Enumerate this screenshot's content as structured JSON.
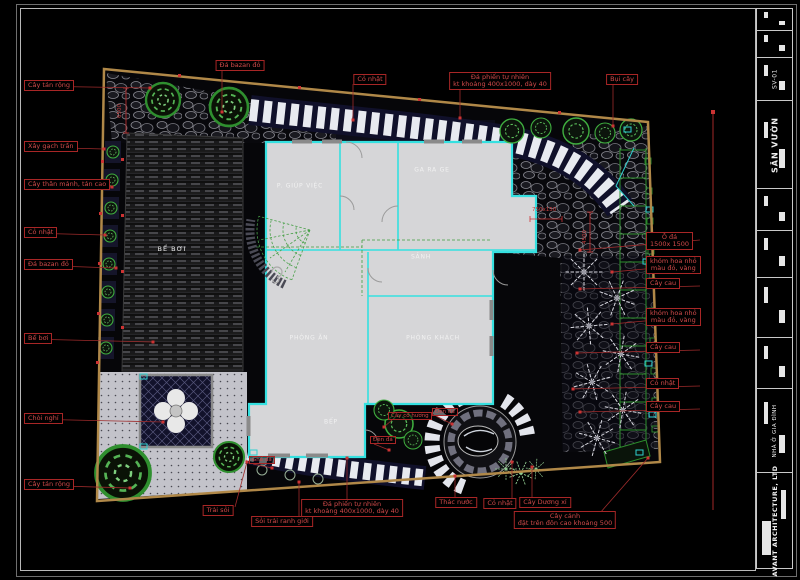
{
  "drawing": {
    "discipline": "landscape-site-plan",
    "sheet_title": "SÂN VƯỜN",
    "sheet_number": "SV-01",
    "project": "NHÀ Ở GIA ĐÌNH",
    "firm": "AVANT ARCHITECTURE, LTD"
  },
  "annotations": {
    "left": [
      {
        "text": "Cây tán rộng",
        "y": 86,
        "tx": 150,
        "ty": 88
      },
      {
        "text": "Xây gạch trần",
        "y": 147,
        "tx": 104,
        "ty": 149
      },
      {
        "text": "Cây thân mảnh, tán cao",
        "y": 185,
        "tx": 112,
        "ty": 187
      },
      {
        "text": "Cỏ nhật",
        "y": 233,
        "tx": 105,
        "ty": 235
      },
      {
        "text": "Đá bazan đỏ",
        "y": 265,
        "tx": 116,
        "ty": 268
      },
      {
        "text": "Bể bơi",
        "y": 339,
        "tx": 153,
        "ty": 342
      },
      {
        "text": "Chòi nghỉ",
        "y": 419,
        "tx": 163,
        "ty": 422
      },
      {
        "text": "Cây tán rộng",
        "y": 485,
        "tx": 130,
        "ty": 488
      }
    ],
    "top": [
      {
        "lines": [
          "Đá bazan đỏ"
        ],
        "cx": 240,
        "y": 60,
        "lx": 222,
        "ty": 112
      },
      {
        "lines": [
          "Cỏ nhật"
        ],
        "cx": 370,
        "y": 74,
        "lx": 353,
        "ty": 120
      },
      {
        "lines": [
          "Đá phiến tự nhiên",
          "kt khoảng 400x1000, dày 40"
        ],
        "cx": 500,
        "y": 72,
        "lx": 460,
        "ty": 118
      },
      {
        "lines": [
          "Bụi cây"
        ],
        "cx": 622,
        "y": 74,
        "lx": 613,
        "ty": 126
      }
    ],
    "right": [
      {
        "lines": [
          "Ô đá",
          "1500x 1500"
        ],
        "y": 238,
        "tx": 580,
        "ty": 250
      },
      {
        "lines": [
          "khóm hoa nhỏ",
          "màu đỏ, vàng"
        ],
        "y": 262,
        "tx": 612,
        "ty": 272
      },
      {
        "lines": [
          "Cây cau"
        ],
        "y": 284,
        "tx": 580,
        "ty": 289
      },
      {
        "lines": [
          "khóm hoa nhỏ",
          "màu đỏ, vàng"
        ],
        "y": 314,
        "tx": 612,
        "ty": 324
      },
      {
        "lines": [
          "Cây cau"
        ],
        "y": 348,
        "tx": 577,
        "ty": 353
      },
      {
        "lines": [
          "Cỏ nhật"
        ],
        "y": 384,
        "tx": 573,
        "ty": 389
      },
      {
        "lines": [
          "Cây cau"
        ],
        "y": 407,
        "tx": 580,
        "ty": 412
      }
    ],
    "bottom": [
      {
        "lines": [
          "Trải sỏi"
        ],
        "cx": 218,
        "y": 505,
        "lx": 235,
        "tx": 247,
        "ty": 462
      },
      {
        "lines": [
          "Sỏi trải ranh giới"
        ],
        "cx": 282,
        "y": 516,
        "lx": 299,
        "tx": 299,
        "ty": 482
      },
      {
        "lines": [
          "Đá phiến tự nhiên",
          "kt khoảng 400x1000, dày 40"
        ],
        "cx": 352,
        "y": 499,
        "lx": 347,
        "tx": 347,
        "ty": 458
      },
      {
        "lines": [
          "Thác nước"
        ],
        "cx": 456,
        "y": 497,
        "lx": 455,
        "tx": 455,
        "ty": 476
      },
      {
        "lines": [
          "Cỏ nhật"
        ],
        "cx": 500,
        "y": 498,
        "lx": 512,
        "tx": 512,
        "ty": 462
      },
      {
        "lines": [
          "Cây Dương xỉ"
        ],
        "cx": 545,
        "y": 497,
        "lx": 532,
        "tx": 532,
        "ty": 467
      },
      {
        "lines": [
          "Cây cảnh",
          "đặt trên đôn cao khoảng 500"
        ],
        "cx": 565,
        "y": 511,
        "lx": 600,
        "tx": 648,
        "ty": 458
      }
    ],
    "inner": [
      {
        "text": "Cây cỏ hương",
        "x": 388,
        "y": 412,
        "tx": 384,
        "ty": 427
      },
      {
        "text": "Đèn đá",
        "x": 432,
        "y": 408,
        "tx": 452,
        "ty": 424
      },
      {
        "text": "Đèn đá",
        "x": 370,
        "y": 436,
        "tx": 389,
        "ty": 450
      },
      {
        "text": "Ghế đá",
        "x": 249,
        "y": 456,
        "tx": 272,
        "ty": 468
      }
    ]
  },
  "rooms": [
    {
      "name": "P. GIÚP VIỆC",
      "x": 300,
      "y": 186
    },
    {
      "name": "GA RA GE",
      "x": 432,
      "y": 170
    },
    {
      "name": "SẢNH",
      "x": 421,
      "y": 257
    },
    {
      "name": "PHÒNG ĂN",
      "x": 309,
      "y": 338
    },
    {
      "name": "PHÒNG KHÁCH",
      "x": 433,
      "y": 338
    },
    {
      "name": "BẾP",
      "x": 331,
      "y": 422
    }
  ],
  "site_labels": [
    {
      "text": "BỂ BƠI",
      "x": 172,
      "y": 249
    }
  ],
  "dims": [
    {
      "text": "6500",
      "x": 117,
      "y": 118,
      "rot": true
    },
    {
      "text": "4500",
      "x": 582,
      "y": 244,
      "rot": true
    },
    {
      "text": "750x150",
      "x": 532,
      "y": 207,
      "rot": false
    }
  ],
  "titleblock": {
    "cells": [
      {
        "label": ""
      },
      {
        "label": ""
      },
      {
        "label": "SV-01"
      },
      {
        "label": "SÂN VƯỜN"
      },
      {
        "label": ""
      },
      {
        "label": ""
      },
      {
        "label": ""
      },
      {
        "label": ""
      },
      {
        "label": "NHÀ Ở GIA ĐÌNH"
      },
      {
        "label": "AVANT ARCHITECTURE, LTD"
      }
    ]
  },
  "colors": {
    "background": "#000000",
    "boundary_tan": "#b08848",
    "annotation_red": "#cc4444",
    "wall_cyan": "#35e0e0",
    "floor_gray": "#d6d6d8",
    "vegetation_green": "#3fae3f",
    "stone_white": "#e8eaf0"
  }
}
